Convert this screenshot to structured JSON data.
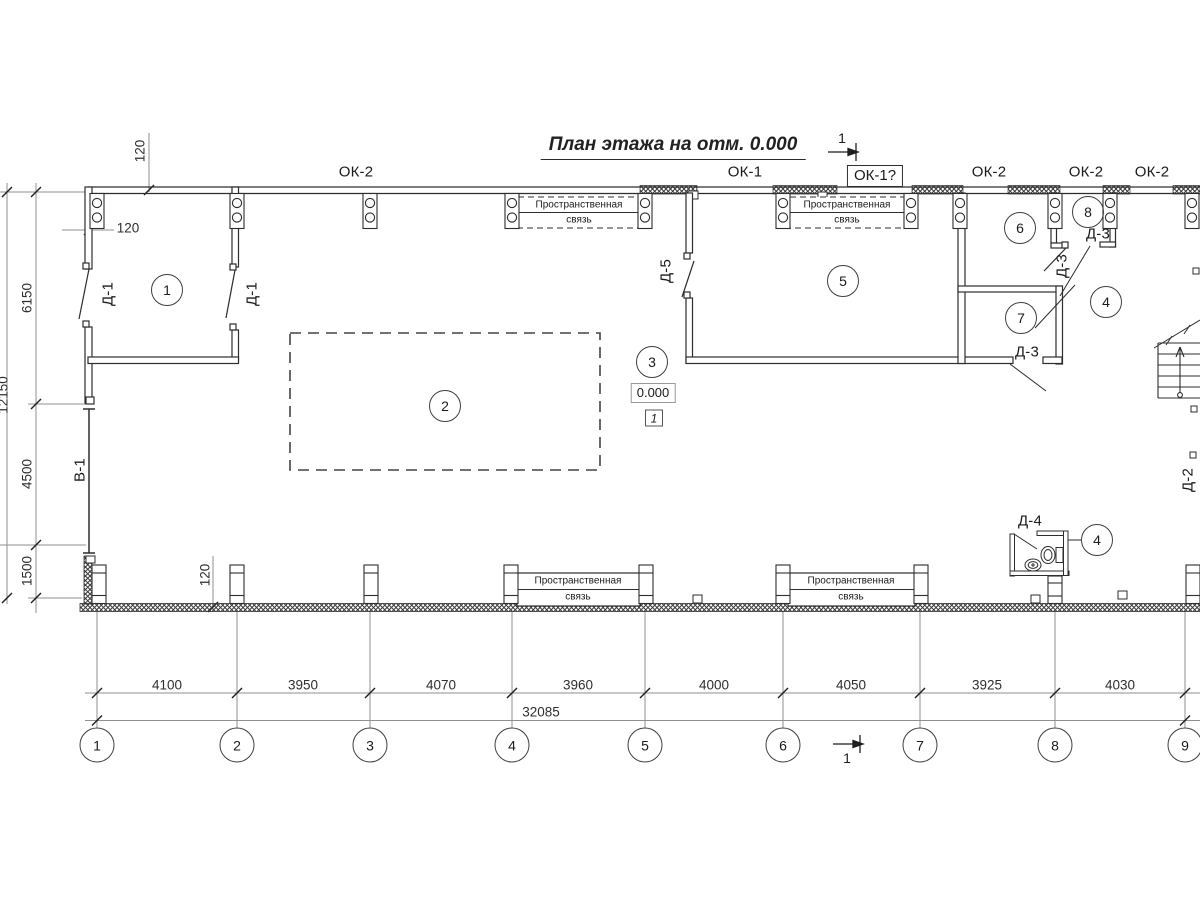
{
  "title": "План этажа на отм. 0.000",
  "labels": {
    "windows": [
      "ОК-2",
      "ОК-1",
      "ОК-1?",
      "ОК-2",
      "ОК-2",
      "ОК-2"
    ],
    "doors": {
      "d1": "Д-1",
      "d2": "Д-2",
      "d3": "Д-3",
      "d4": "Д-4",
      "d5": "Д-5",
      "gate": "В-1"
    },
    "brace": {
      "line1": "Пространственная",
      "line2": "связь"
    },
    "elevation": "0.000",
    "elevation_flag": "1",
    "section": "1"
  },
  "rooms": [
    "1",
    "2",
    "3",
    "5",
    "6",
    "7",
    "8",
    "4",
    "4"
  ],
  "grid": {
    "cols": [
      "1",
      "2",
      "3",
      "4",
      "5",
      "6",
      "7",
      "8",
      "9"
    ]
  },
  "dims": {
    "bottom": [
      "4100",
      "3950",
      "4070",
      "3960",
      "4000",
      "4050",
      "3925",
      "4030"
    ],
    "bottom_total": "32085",
    "left": [
      "6150",
      "4500",
      "1500"
    ],
    "left_total": "12150",
    "wall": "120"
  }
}
